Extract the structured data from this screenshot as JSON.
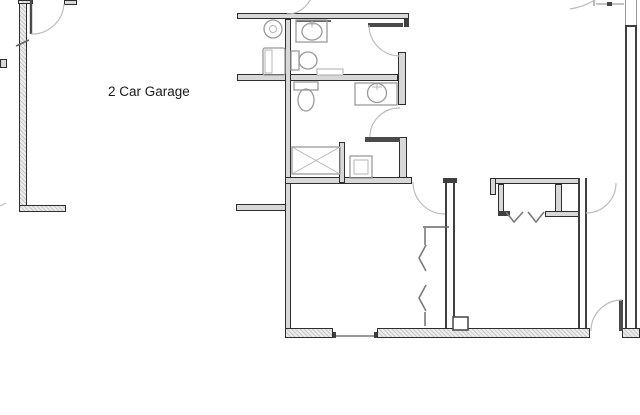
{
  "labels": {
    "garage": "2 Car Garage"
  },
  "colors": {
    "background": "#ffffff",
    "wall_edge": "#2d2d2d",
    "wall_core": "#d8d8d8",
    "exterior_line": "#c9c9c9",
    "exterior_fill": "#ececec",
    "stud_edge": "#3f3f3f",
    "fixture_stroke": "#9a9a9a",
    "arc_stroke": "#bcbcbc",
    "door_leaf": "#4a4a4a",
    "text": "#1a1a1a"
  },
  "fixtures": [
    "water-heater",
    "washer",
    "upper-vanity-sink",
    "upper-toilet",
    "lower-toilet",
    "lower-vanity-sink",
    "shower-xbox",
    "utility-square",
    "vertical-bifold-closet",
    "horizontal-bifold-closet",
    "floor-box",
    "window-opening"
  ],
  "doors": [
    "garage-entry-door",
    "top-edge-door",
    "upper-bath-door",
    "lower-bath-door",
    "bedroom1-door",
    "right-room-door",
    "rear-exterior-door"
  ]
}
